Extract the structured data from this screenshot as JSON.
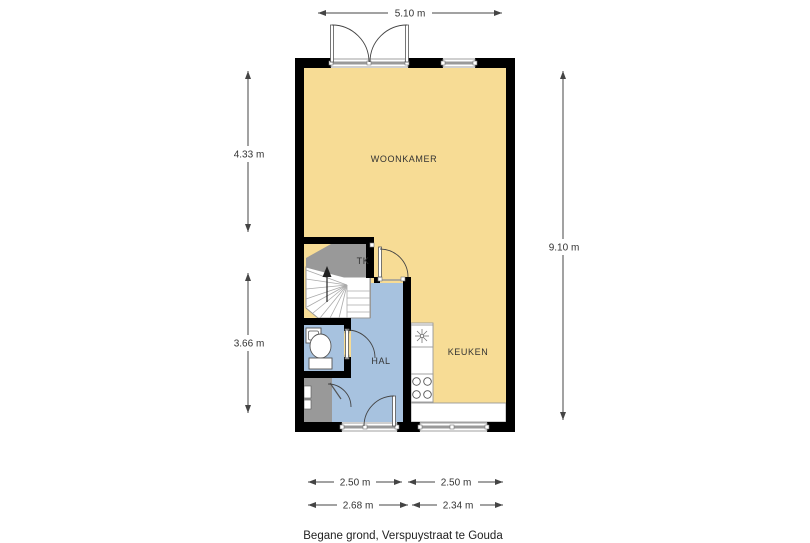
{
  "title": "Begane grond, Verspuystraat te Gouda",
  "rooms": {
    "woonkamer": "WOONKAMER",
    "keuken": "KEUKEN",
    "hal": "HAL",
    "tk": "TK"
  },
  "dimensions": {
    "top_width": "5.10 m",
    "left_upper": "4.33 m",
    "left_lower": "3.66 m",
    "right_height": "9.10 m",
    "bottom_inner_left": "2.50 m",
    "bottom_inner_right": "2.50 m",
    "bottom_outer_left": "2.68 m",
    "bottom_outer_right": "2.34 m"
  },
  "colors": {
    "wall": "#000000",
    "living_floor": "#F7DC95",
    "hall_floor": "#A7C2DF",
    "closet_floor": "#999999",
    "background": "#FFFFFF"
  }
}
